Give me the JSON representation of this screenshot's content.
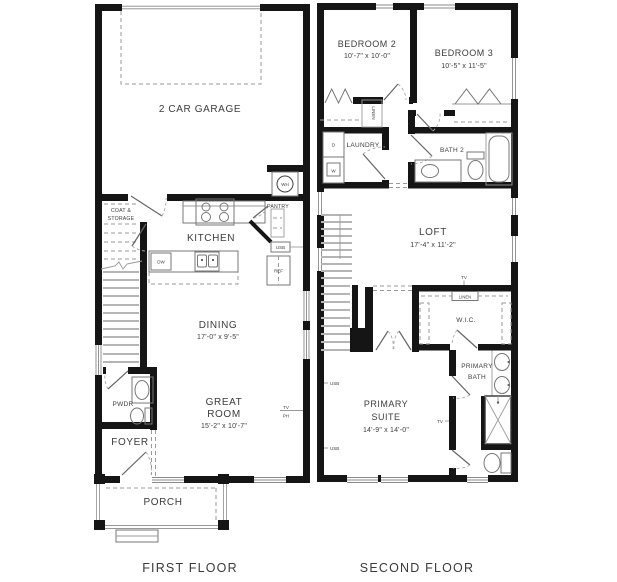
{
  "canvas": {
    "width": 617,
    "height": 582,
    "background": "#ffffff"
  },
  "palette": {
    "wall": "#151515",
    "fixture_line": "#777777",
    "tread": "#b5b5b5",
    "dashed": "#9a9a9a",
    "text": "#3d3d3d"
  },
  "first_floor": {
    "caption": "FIRST FLOOR",
    "garage": {
      "name": "2 CAR GARAGE"
    },
    "water_heater": {
      "label": "WH"
    },
    "coat_storage": {
      "line1": "COAT &",
      "line2": "STORAGE"
    },
    "kitchen": {
      "name": "KITCHEN"
    },
    "pantry": {
      "name": "PANTRY"
    },
    "usb": {
      "label": "USB"
    },
    "refrigerator": {
      "label": "REF"
    },
    "dishwasher": {
      "label": "DW"
    },
    "dining": {
      "name": "DINING",
      "dims": "17'-0\" x 9'-5\""
    },
    "powder": {
      "name": "PWDR"
    },
    "foyer": {
      "name": "FOYER"
    },
    "great_room": {
      "line1": "GREAT",
      "line2": "ROOM",
      "dims": "15'-2\" x 10'-7\""
    },
    "tv": {
      "line1": "TV",
      "line2": "PH"
    },
    "porch": {
      "name": "PORCH"
    }
  },
  "second_floor": {
    "caption": "SECOND FLOOR",
    "bedroom2": {
      "name": "BEDROOM 2",
      "dims": "10'-7\" x 10'-0\""
    },
    "bedroom3": {
      "name": "BEDROOM 3",
      "dims": "10'-5\" x 11'-5\""
    },
    "linen_upper": {
      "label": "LINEN"
    },
    "laundry": {
      "name": "LAUNDRY"
    },
    "dryer": {
      "label": "D"
    },
    "washer": {
      "label": "W"
    },
    "bath2": {
      "name": "BATH 2"
    },
    "loft": {
      "name": "LOFT",
      "dims": "17'-4\" x 11'-2\""
    },
    "tv_loft": {
      "label": "TV"
    },
    "linen_lower": {
      "label": "LINEN"
    },
    "wic": {
      "name": "W.I.C."
    },
    "primary_bath": {
      "line1": "PRIMARY",
      "line2": "BATH"
    },
    "primary_suite": {
      "line1": "PRIMARY",
      "line2": "SUITE",
      "dims": "14'-9\" x 14'-0\""
    },
    "usb_upper": {
      "label": "USB"
    },
    "usb_lower": {
      "label": "USB"
    },
    "tv_suite": {
      "label": "TV"
    }
  }
}
